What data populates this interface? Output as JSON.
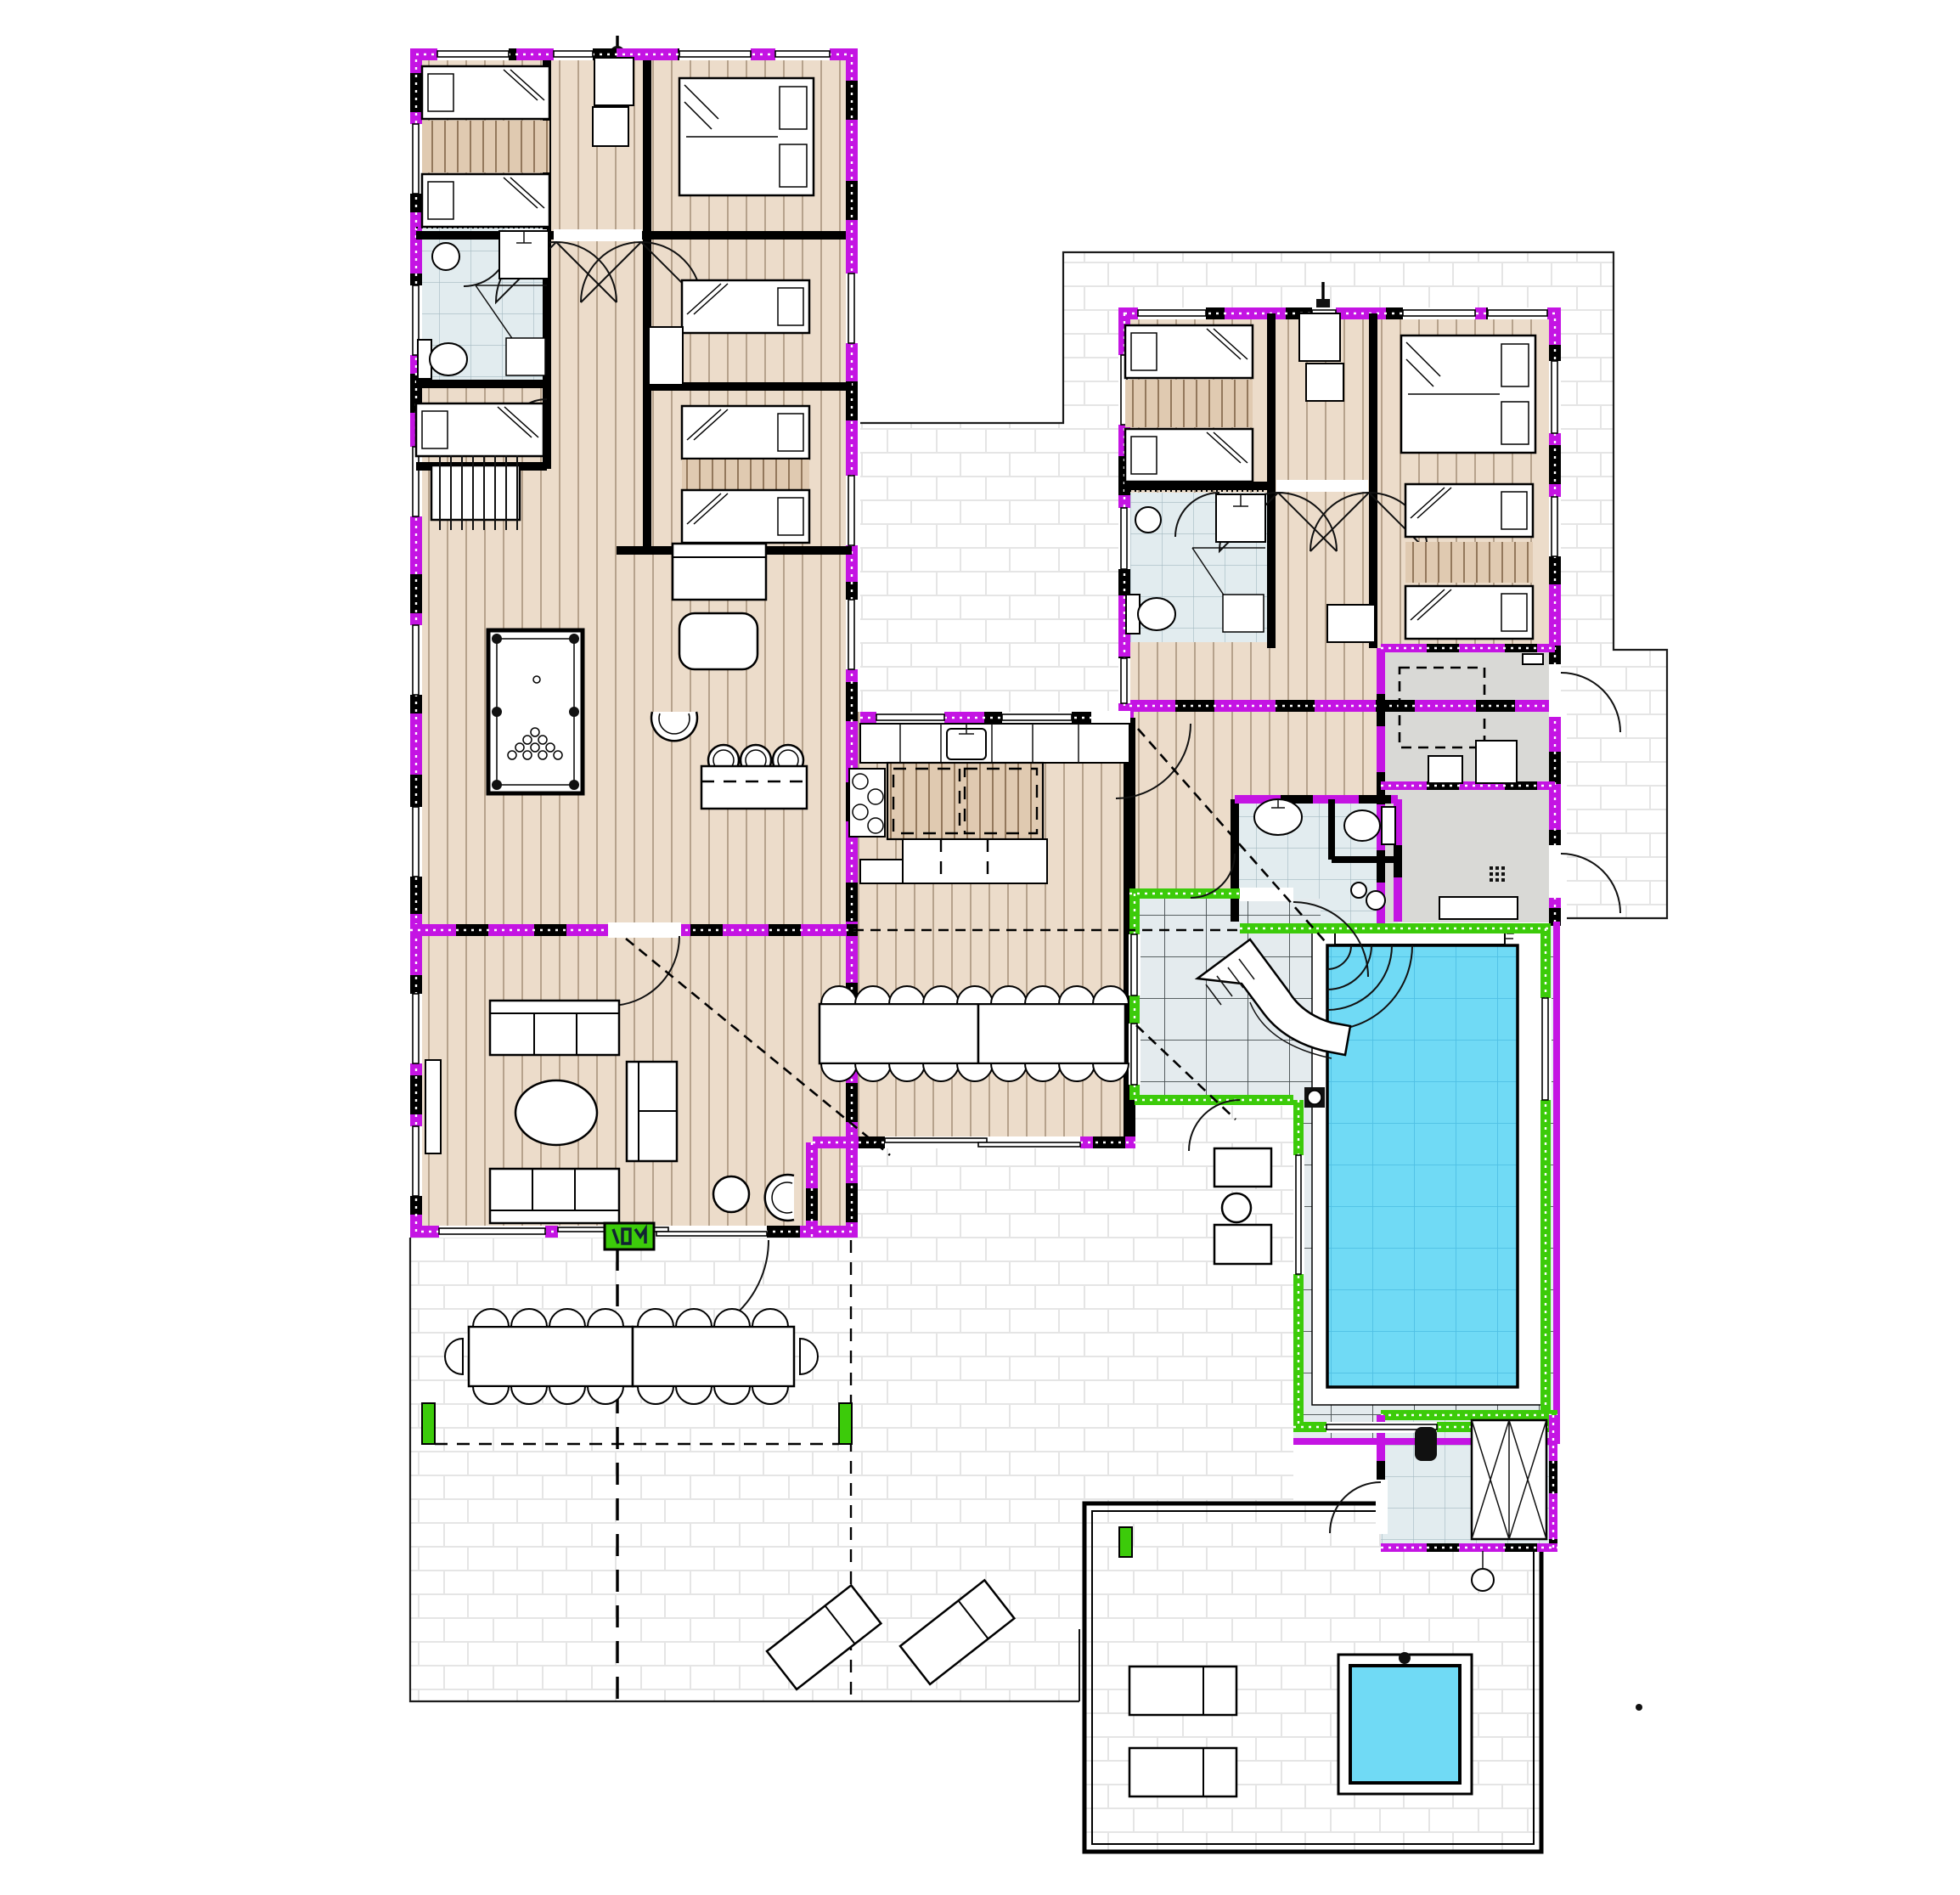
{
  "document": {
    "kind": "architectural-floor-plan",
    "view": "top-down ground floor plan of a holiday villa with indoor pool wing",
    "visible_text": []
  },
  "colors": {
    "background": "#ffffff",
    "wall": "#000000",
    "exterior_highlight": "#c414e3",
    "pool_room_highlight": "#3ccb0a",
    "water": "#70daf5",
    "water_grid": "#4fc0e4",
    "wood_floor": "#ecdcca",
    "wood_grain": "#a9937c",
    "rug": "#e0cab1",
    "rug_stripe": "#93785c",
    "bathroom_tile": "#e2ecef",
    "bathroom_grid": "#a4b9c1",
    "pool_deck_tile": "#e4ebee",
    "pool_deck_grid": "#454d4f",
    "terrace_tile": "#ffffff",
    "terrace_grid": "#e5e5e5",
    "technical_room": "#d9d9d6",
    "outline": "#1c1c1c"
  },
  "legend": {
    "magenta_walls": "exterior insulated walls (highlighted)",
    "green_walls": "pool-room walls (highlighted)",
    "dashed_vertical_lines": "section cut lines",
    "dashed_diagonals": "ceiling ridge lines",
    "white_gaps_in_walls": "windows and glazed doors"
  },
  "inventory": {
    "single_beds": 10,
    "double_beds": 2,
    "bathrooms": 4,
    "saunas": 1,
    "technical_rooms": 2,
    "indoor_pool": 1,
    "water_slide": 1,
    "outdoor_hot_tub": 1,
    "billiard_table": 1,
    "foosball_table": 1,
    "indoor_dining_seats": 18,
    "outdoor_dining_seats": 18,
    "sofas": 3,
    "armchairs": 2,
    "bar_stools": 3,
    "sun_loungers": 4,
    "wardrobe_closets": 3
  },
  "markers": {
    "entry_badge_color": "#3ccb0a",
    "section_marker_top_left": "filled circle",
    "section_marker_top_right": "filled square"
  }
}
